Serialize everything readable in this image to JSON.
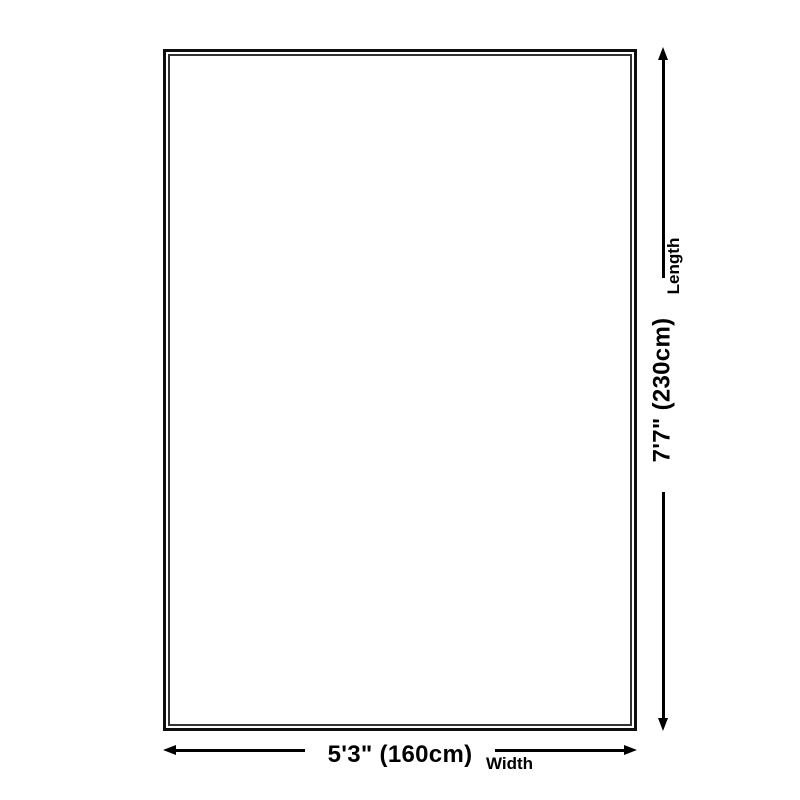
{
  "diagram": {
    "kind": "rug-size-dimension-diagram",
    "colors": {
      "ink": "#000000",
      "background": "#ffffff",
      "outer_border": "#0f0f0f",
      "inner_border": "#333333"
    },
    "dimensions": {
      "length": {
        "label": "Length",
        "value": "7'7\" (230cm)"
      },
      "width": {
        "label": "Width",
        "value": "5'3\" (160cm)"
      }
    }
  }
}
